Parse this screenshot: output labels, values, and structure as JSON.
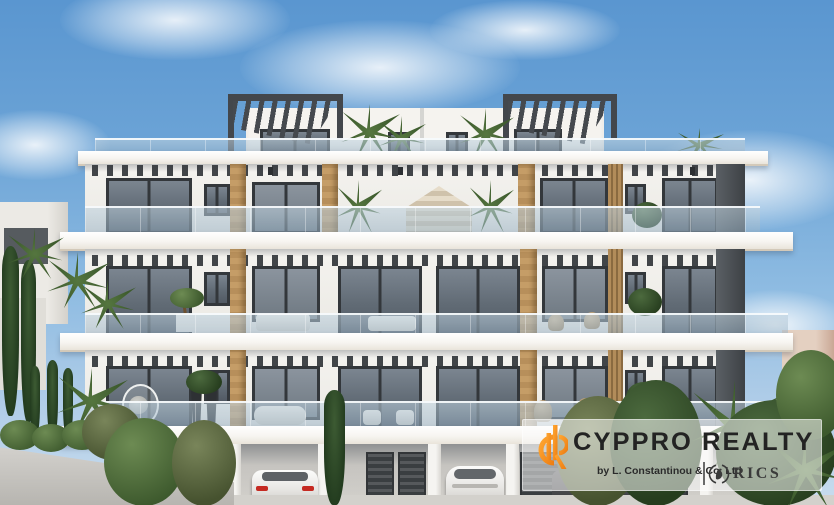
{
  "scene": {
    "description": "3D architectural rendering of a modern four-storey white apartment building in Cyprus: rooftop pergolas, glass balconies, timber columns, covered parking with cars, palms and cypress trees under a blue sky",
    "colors": {
      "sky_top": "#5a96d0",
      "sky_bottom": "#c8dcee",
      "building_white": "#f2f1ed",
      "window_frame": "#33373b",
      "glass": "#6d7884",
      "wood": "#c19a64",
      "pergola": "#45494e",
      "greenery": "#4d6b3c",
      "logo_orange": "#f7941d",
      "logo_text": "#232323"
    }
  },
  "watermark": {
    "brand": "CYPPRO REALTY",
    "byline": "by L. Constantinou & Co. Ltd",
    "rics_label": "RICS"
  }
}
